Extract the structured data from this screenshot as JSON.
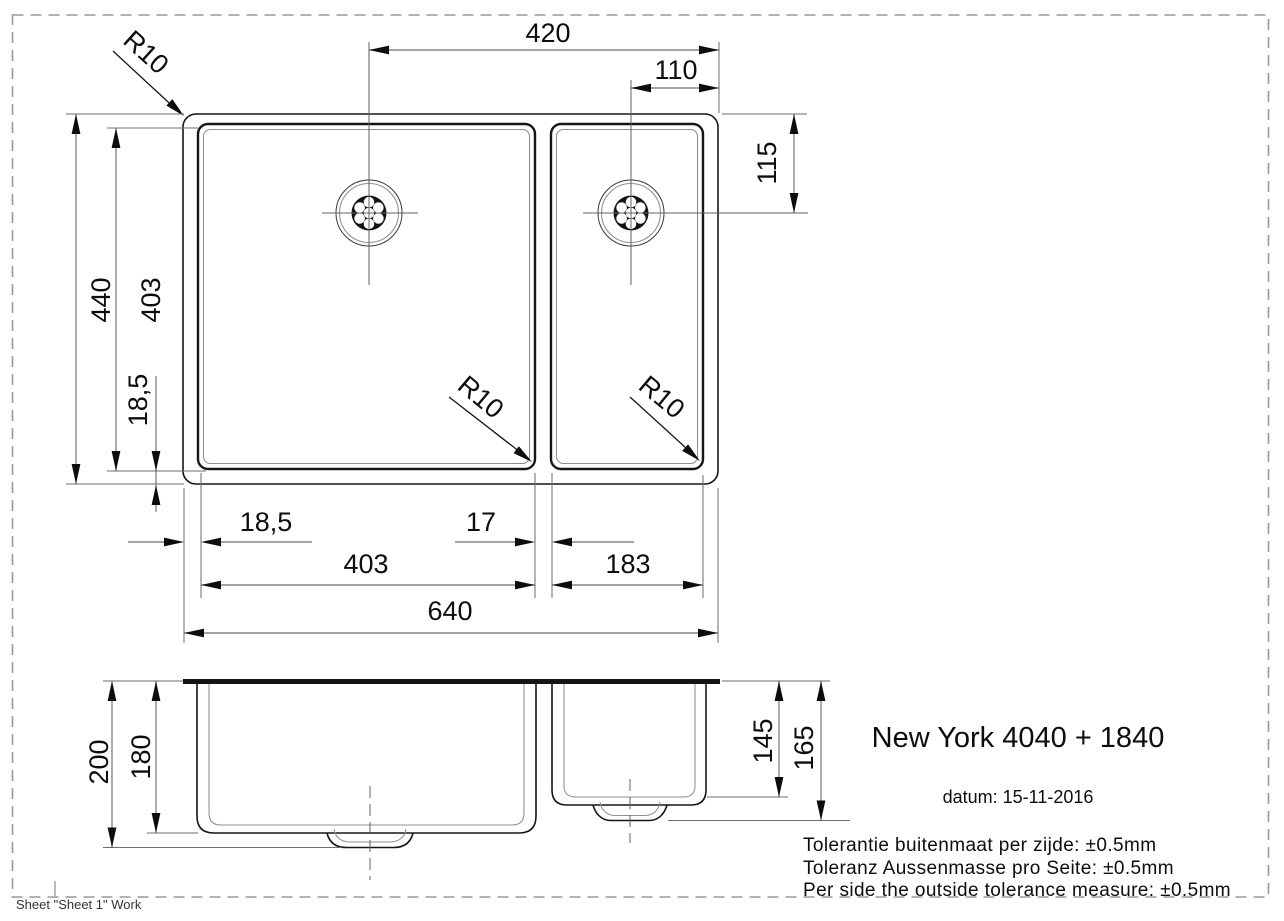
{
  "sheet": {
    "label": "Sheet \"Sheet 1\" Work"
  },
  "top_view": {
    "radius_label": "R10",
    "dims": {
      "drain_to_right_edge_420": "420",
      "small_drain_to_edge_110": "110",
      "small_drain_from_top_115": "115",
      "outer_height_440": "440",
      "bowl_height_403": "403",
      "bottom_inset_18_5": "18,5",
      "left_inset_18_5": "18,5",
      "divider_17": "17",
      "left_bowl_width_403": "403",
      "right_bowl_width_183": "183",
      "outer_width_640": "640"
    }
  },
  "side_view": {
    "dims": {
      "left_total_depth_200": "200",
      "left_bowl_depth_180": "180",
      "right_bowl_depth_145": "145",
      "right_total_depth_165": "165"
    }
  },
  "title_block": {
    "model": "New York 4040 + 1840",
    "date": "datum: 15-11-2016",
    "tolerances": [
      "Tolerantie buitenmaat per zijde: ±0.5mm",
      "Toleranz Aussenmasse pro Seite: ±0.5mm",
      "Per side the outside tolerance measure: ±0.5mm"
    ]
  },
  "colors": {
    "drawing_line": "#161616",
    "dimension_line": "#6e6e6e",
    "border_dash": "#999999",
    "background": "#ffffff"
  }
}
